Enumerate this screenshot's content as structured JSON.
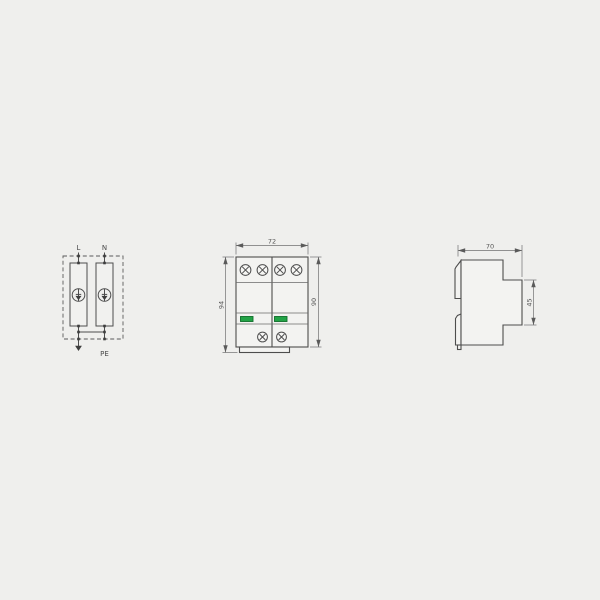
{
  "drawing": {
    "circuit": {
      "terminal_left": "L",
      "terminal_right": "N",
      "terminal_ground": "PE"
    },
    "front_view": {
      "width_mm": "72",
      "total_height_mm": "94",
      "body_height_mm": "90"
    },
    "side_view": {
      "depth_mm": "70",
      "front_height_mm": "45"
    },
    "colors": {
      "background": "#efefed",
      "outline": "#4d4d4d",
      "dimension_lines": "#707070",
      "indicator_green": "#22a346",
      "indicator_green_border": "#0f6e2a"
    },
    "icons": {
      "surge_arrester": "circle with spark-gap arrow (SPD symbol)",
      "ground_arrow": "downward earth arrow",
      "screw": "phillips terminal screw",
      "junction_dot": "wire junction point"
    }
  }
}
